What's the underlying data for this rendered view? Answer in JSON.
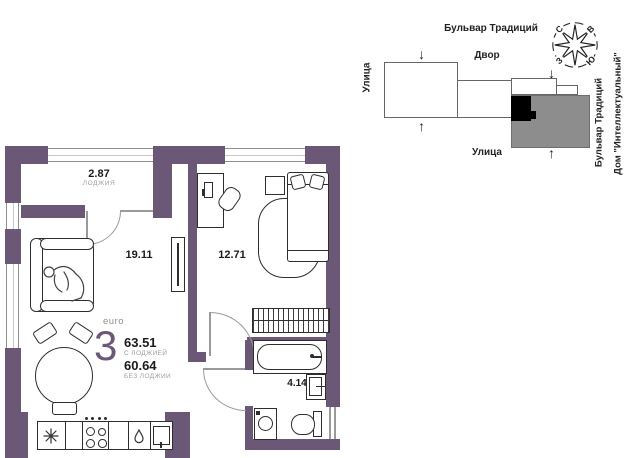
{
  "colors": {
    "wall_purple": "#6A5876",
    "building_gray": "#8d8d8d",
    "highlight_black": "#000000"
  },
  "plan": {
    "loggia": {
      "area": "2.87",
      "label": "ЛОДЖИЯ"
    },
    "living_area": "19.11",
    "bedroom_area": "12.71",
    "bathroom_area": "4.14",
    "summary": {
      "type": "euro",
      "rooms": "3",
      "area_with_loggia": "63.51",
      "with_loggia_label": "С ЛОДЖИЕЙ",
      "area_without_loggia": "60.64",
      "without_loggia_label": "БЕЗ ЛОДЖИИ"
    }
  },
  "map": {
    "street_top": "Бульвар Традиций",
    "courtyard_label": "Двор",
    "street_left": "Улица",
    "street_bottom": "Улица",
    "boulevard_right": "Бульвар Традиций",
    "house_name": "Дом \"Интеллектуальный\"",
    "arrow_down": "↓",
    "arrow_up": "↑",
    "compass": {
      "north": "С",
      "east": "В",
      "west": "З",
      "south": "Ю"
    }
  }
}
